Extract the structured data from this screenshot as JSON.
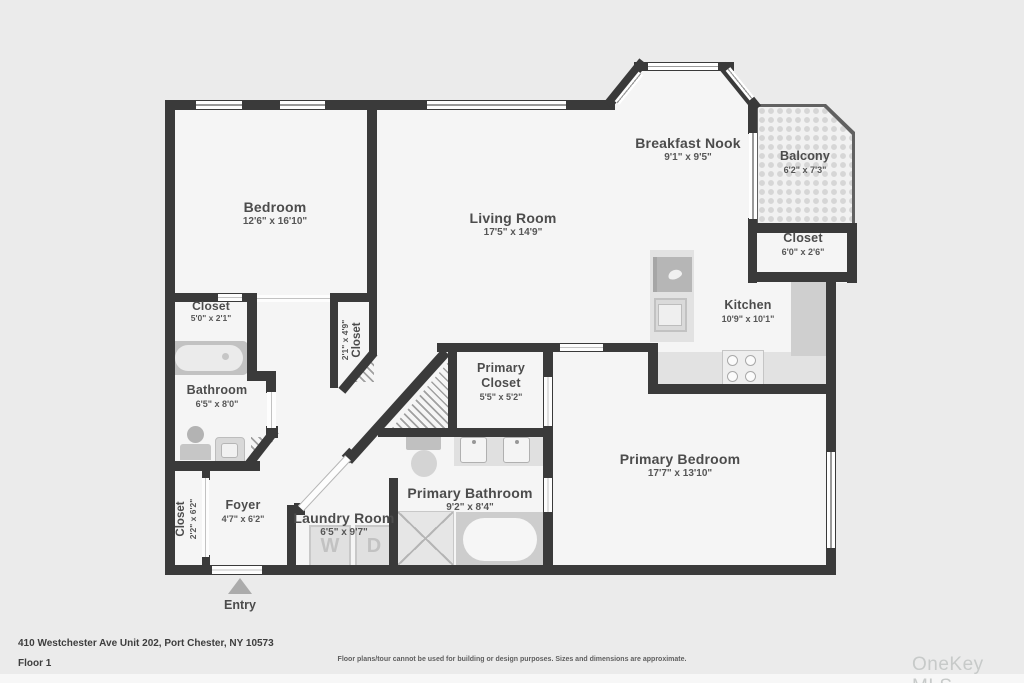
{
  "plan": {
    "entry_label": "Entry",
    "rooms": [
      {
        "id": "bedroom",
        "label": "Bedroom",
        "dims": "12'6\" x 16'10\""
      },
      {
        "id": "living-room",
        "label": "Living Room",
        "dims": "17'5\" x 14'9\""
      },
      {
        "id": "breakfast-nook",
        "label": "Breakfast Nook",
        "dims": "9'1\" x 9'5\""
      },
      {
        "id": "balcony",
        "label": "Balcony",
        "dims": "6'2\" x 7'3\""
      },
      {
        "id": "balcony-closet",
        "label": "Closet",
        "dims": "6'0\" x 2'6\""
      },
      {
        "id": "kitchen",
        "label": "Kitchen",
        "dims": "10'9\" x 10'1\""
      },
      {
        "id": "bedroom-closet",
        "label": "Closet",
        "dims": "5'0\" x 2'1\""
      },
      {
        "id": "hall-closet",
        "label": "Closet",
        "dims": "2'1\" x 4'9\""
      },
      {
        "id": "bathroom",
        "label": "Bathroom",
        "dims": "6'5\" x 8'0\""
      },
      {
        "id": "primary-closet",
        "label": "Primary Closet",
        "dims": "5'5\" x 5'2\""
      },
      {
        "id": "primary-bathroom",
        "label": "Primary Bathroom",
        "dims": "9'2\" x 8'4\""
      },
      {
        "id": "primary-bedroom",
        "label": "Primary Bedroom",
        "dims": "17'7\" x 13'10\""
      },
      {
        "id": "foyer",
        "label": "Foyer",
        "dims": "4'7\" x 6'2\""
      },
      {
        "id": "entry-closet",
        "label": "Closet",
        "dims": "2'2\" x 6'2\""
      },
      {
        "id": "laundry-room",
        "label": "Laundry Room",
        "dims": "6'5\" x 9'7\""
      }
    ],
    "appliances": {
      "washer_letter": "W",
      "dryer_letter": "D"
    }
  },
  "footer": {
    "address": "410 Westchester Ave Unit 202, Port Chester, NY 10573",
    "floor": "Floor 1",
    "disclaimer": "Floor plans/tour cannot be used for building or design purposes. Sizes and dimensions are approximate.",
    "watermark": "OneKey MLS"
  },
  "colors": {
    "wall": "#3a3a3a",
    "room_fill": "#f5f5f5",
    "background": "#ebebeb",
    "label_text": "#4c4c4c",
    "fixture_gray": "#c9c9c9"
  }
}
